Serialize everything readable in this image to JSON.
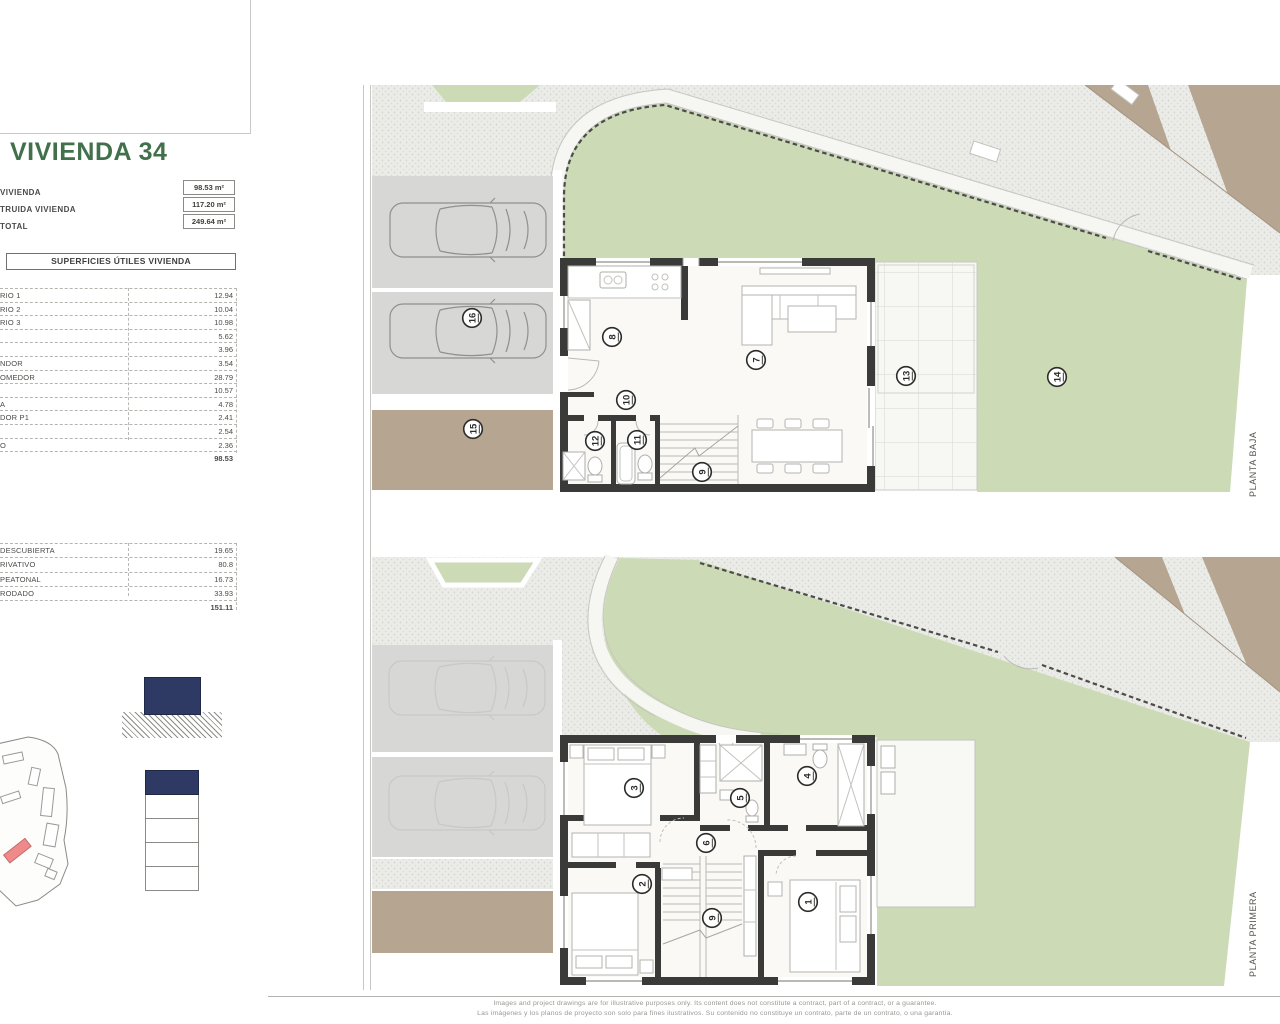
{
  "left_panel": {
    "title": "VIVIENDA 34",
    "summary": [
      {
        "label": "VIVIENDA",
        "value": "98.53 m²"
      },
      {
        "label": "TRUIDA VIVIENDA",
        "value": "117.20 m²"
      },
      {
        "label": "TOTAL",
        "value": "249.64 m²"
      }
    ],
    "useful_areas": {
      "header": "SUPERFICIES ÚTILES VIVIENDA",
      "rows": [
        {
          "label": "RIO 1",
          "value": "12.94"
        },
        {
          "label": "RIO 2",
          "value": "10.04"
        },
        {
          "label": "RIO 3",
          "value": "10.98"
        },
        {
          "label": "",
          "value": "5.62"
        },
        {
          "label": "",
          "value": "3.96"
        },
        {
          "label": "NDOR",
          "value": "3.54"
        },
        {
          "label": "OMEDOR",
          "value": "28.79"
        },
        {
          "label": "",
          "value": "10.57"
        },
        {
          "label": "A",
          "value": "4.78"
        },
        {
          "label": "DOR P1",
          "value": "2.41"
        },
        {
          "label": "",
          "value": "2.54"
        },
        {
          "label": "O",
          "value": "2.36"
        }
      ],
      "total": "98.53"
    },
    "exterior_areas": {
      "rows": [
        {
          "label": "DESCUBIERTA",
          "value": "19.65"
        },
        {
          "label": "RIVATIVO",
          "value": "80.8"
        },
        {
          "label": "PEATONAL",
          "value": "16.73"
        },
        {
          "label": "RODADO",
          "value": "33.93"
        }
      ],
      "total": "151.11"
    }
  },
  "plans": {
    "baja": {
      "side_label": "PLANTA BAJA",
      "circles": [
        {
          "n": "8"
        },
        {
          "n": "7"
        },
        {
          "n": "10"
        },
        {
          "n": "12"
        },
        {
          "n": "11"
        },
        {
          "n": "9"
        },
        {
          "n": "13"
        },
        {
          "n": "14"
        },
        {
          "n": "15"
        },
        {
          "n": "16"
        }
      ]
    },
    "primera": {
      "side_label": "PLANTA PRIMERA",
      "circles": [
        {
          "n": "3"
        },
        {
          "n": "5"
        },
        {
          "n": "4"
        },
        {
          "n": "6"
        },
        {
          "n": "2"
        },
        {
          "n": "9"
        },
        {
          "n": "1"
        }
      ]
    }
  },
  "footer": {
    "line_en": "Images and project drawings are for illustrative purposes only. Its content does not constitute a contract, part of a contract, or a guarantee.",
    "line_es": "Las imágenes y los planos de proyecto son solo para fines ilustrativos. Su contenido no constituye un contrato, parte de un contrato, o una garantía."
  },
  "colors": {
    "title_green": "#41704b",
    "lawn": "#ccdab6",
    "pavement": "#ebece8",
    "road_tan": "#b5a591",
    "parking_grey": "#d7d7d5",
    "wall": "#3a3a38",
    "key_navy": "#2e3a63",
    "highlight_red": "#ee8a8a"
  }
}
